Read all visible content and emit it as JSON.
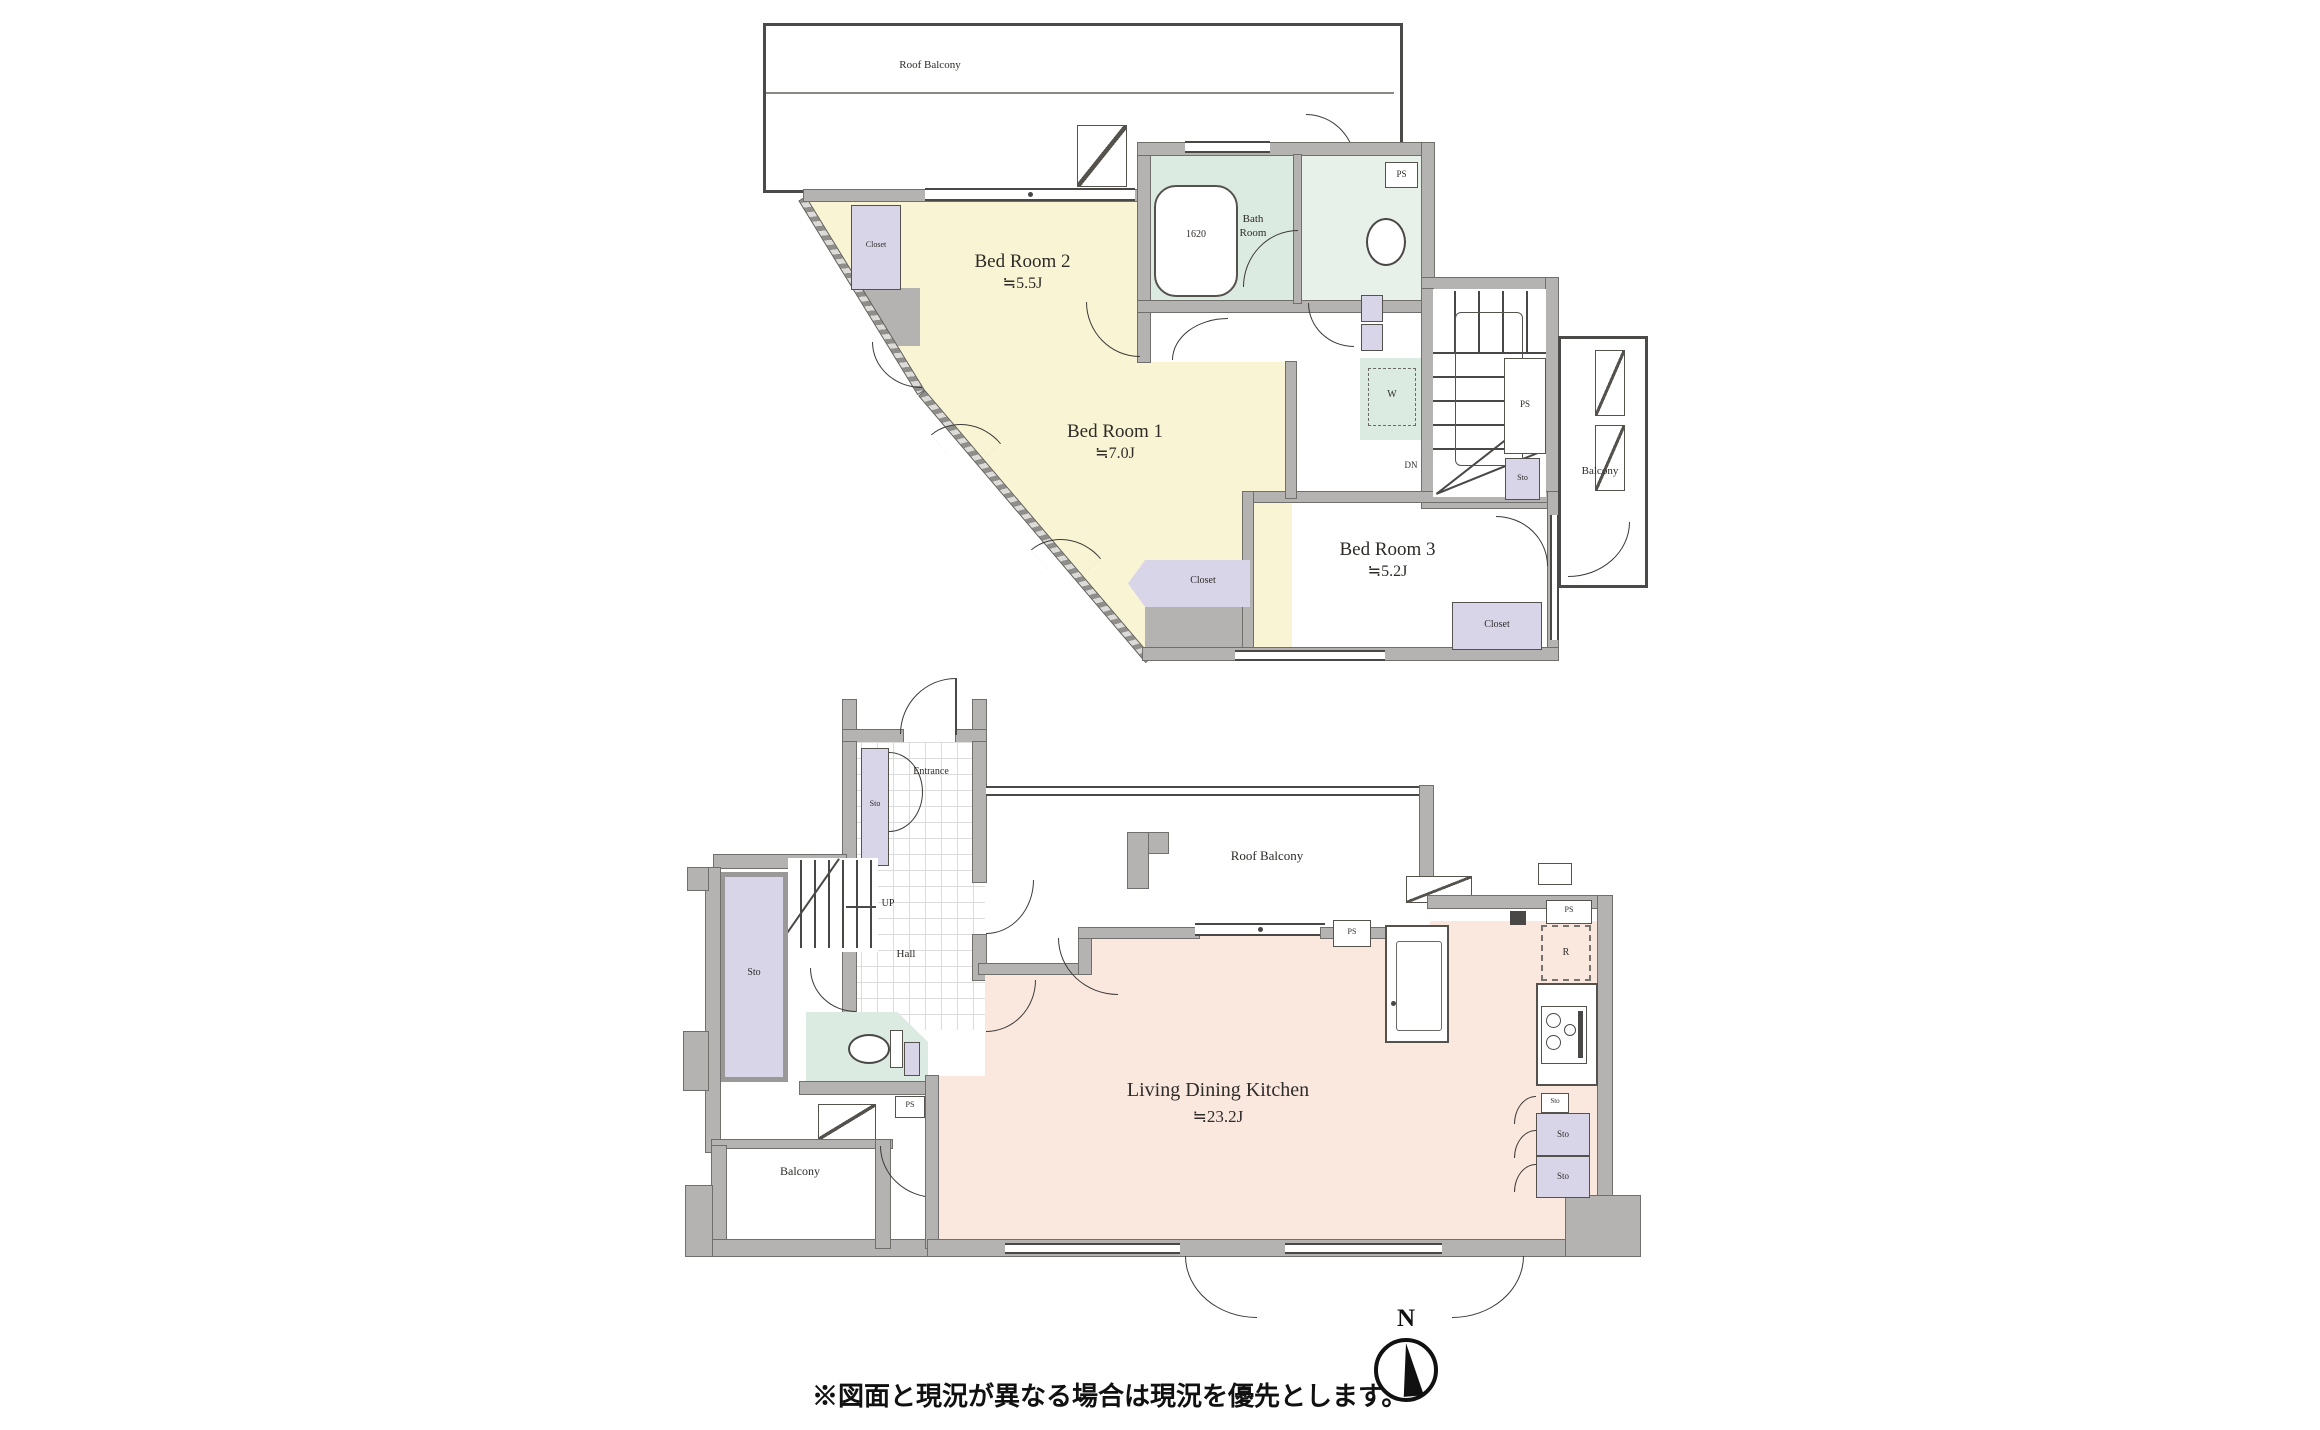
{
  "upper_floor": {
    "roof_balcony": "Roof Balcony",
    "bedroom2": {
      "name": "Bed Room 2",
      "size": "≒5.5J"
    },
    "bedroom1": {
      "name": "Bed Room 1",
      "size": "≒7.0J"
    },
    "bedroom3": {
      "name": "Bed Room 3",
      "size": "≒5.2J"
    },
    "bath": {
      "line1": "Bath",
      "line2": "Room",
      "tub": "1620"
    },
    "closet": "Closet",
    "balcony": "Balcony",
    "washer": "W",
    "down": "DN",
    "ps": "PS",
    "sto": "Sto"
  },
  "lower_floor": {
    "roof_balcony": "Roof Balcony",
    "ldk": {
      "name": "Living Dining Kitchen",
      "size": "≒23.2J"
    },
    "entrance": "Entrance",
    "hall": "Hall",
    "up": "UP",
    "balcony": "Balcony",
    "sto": "Sto",
    "ps": "PS",
    "fridge": "R"
  },
  "footer": {
    "note": "※図面と現況が異なる場合は現況を優先とします。",
    "compass_north": "N"
  }
}
